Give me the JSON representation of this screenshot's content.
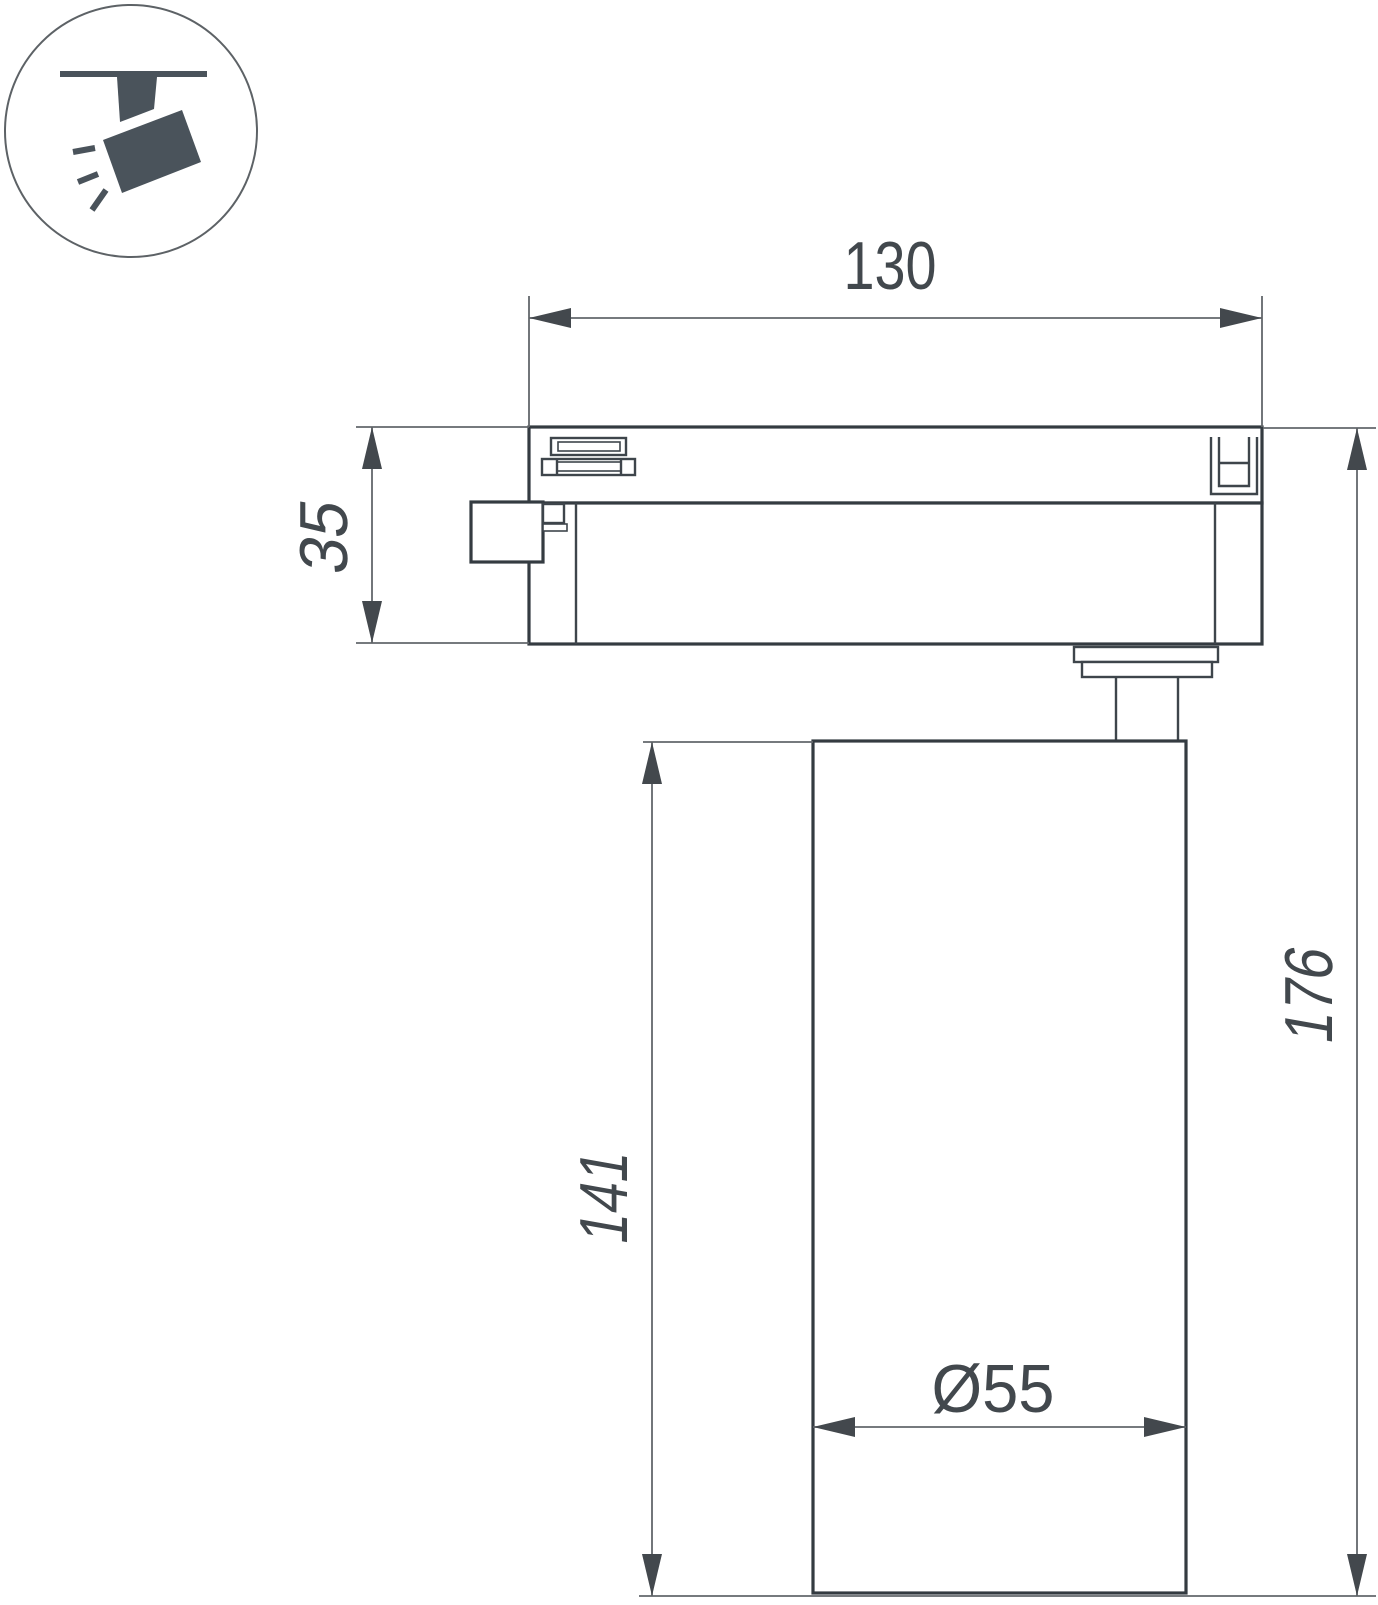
{
  "colors": {
    "line": "#343b41",
    "line_medium": "#3e454b",
    "line_thin": "#63676b",
    "arrow": "#43484d",
    "text": "#42484d",
    "icon": "#4a535b",
    "ring": "#5d6266",
    "background": "#ffffff"
  },
  "icon": {
    "type": "track-spotlight-pictogram"
  },
  "labels": {
    "track_width": "130",
    "adapter_height": "35",
    "body_height": "141",
    "total_height": "176",
    "diameter": "Ø55"
  }
}
